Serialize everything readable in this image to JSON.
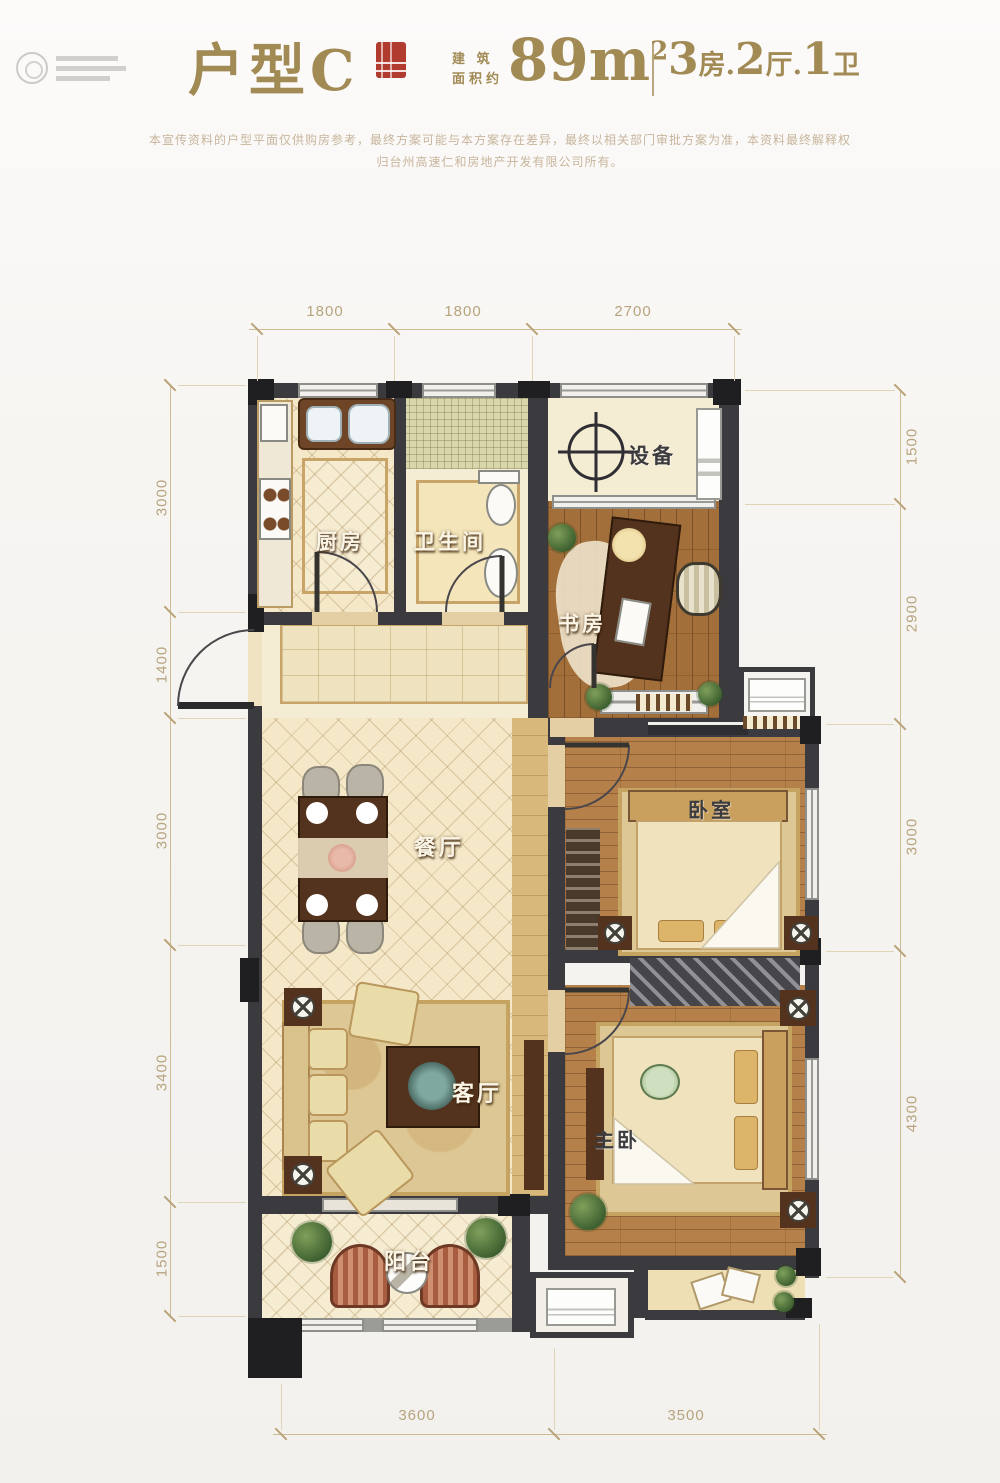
{
  "header": {
    "title": "户型C",
    "area_label_l1": "建 筑",
    "area_label_l2": "面积约",
    "area_value": "89m",
    "area_exp": "2",
    "units": [
      {
        "num": "3",
        "suffix": "房."
      },
      {
        "num": "2",
        "suffix": "厅."
      },
      {
        "num": "1",
        "suffix": "卫"
      }
    ],
    "disclaimer_l1": "本宣传资料的户型平面仅供购房参考，最终方案可能与本方案存在差异，最终以相关部门审批方案为准，本资料最终解释权",
    "disclaimer_l2": "归台州高速仁和房地产开发有限公司所有。"
  },
  "rooms": {
    "kitchen": "厨房",
    "bathroom": "卫生间",
    "equipment": "设备",
    "study": "书房",
    "dining": "餐厅",
    "bedroom": "卧室",
    "living": "客厅",
    "master": "主卧",
    "balcony": "阳台"
  },
  "dimensions": {
    "top": [
      "1800",
      "1800",
      "2700"
    ],
    "bottom": [
      "3600",
      "3500"
    ],
    "left": [
      "3000",
      "1400",
      "3000",
      "3400",
      "1500"
    ],
    "right": [
      "1500",
      "2900",
      "3000",
      "4300"
    ]
  },
  "colors": {
    "accent_gold": "#a28a55",
    "seal_red": "#b23b30",
    "wall": "#3b3a3e",
    "cream_floor": "#f4e8c8",
    "wood_floor": "#a26e3a",
    "dimension": "#b7a47e"
  }
}
